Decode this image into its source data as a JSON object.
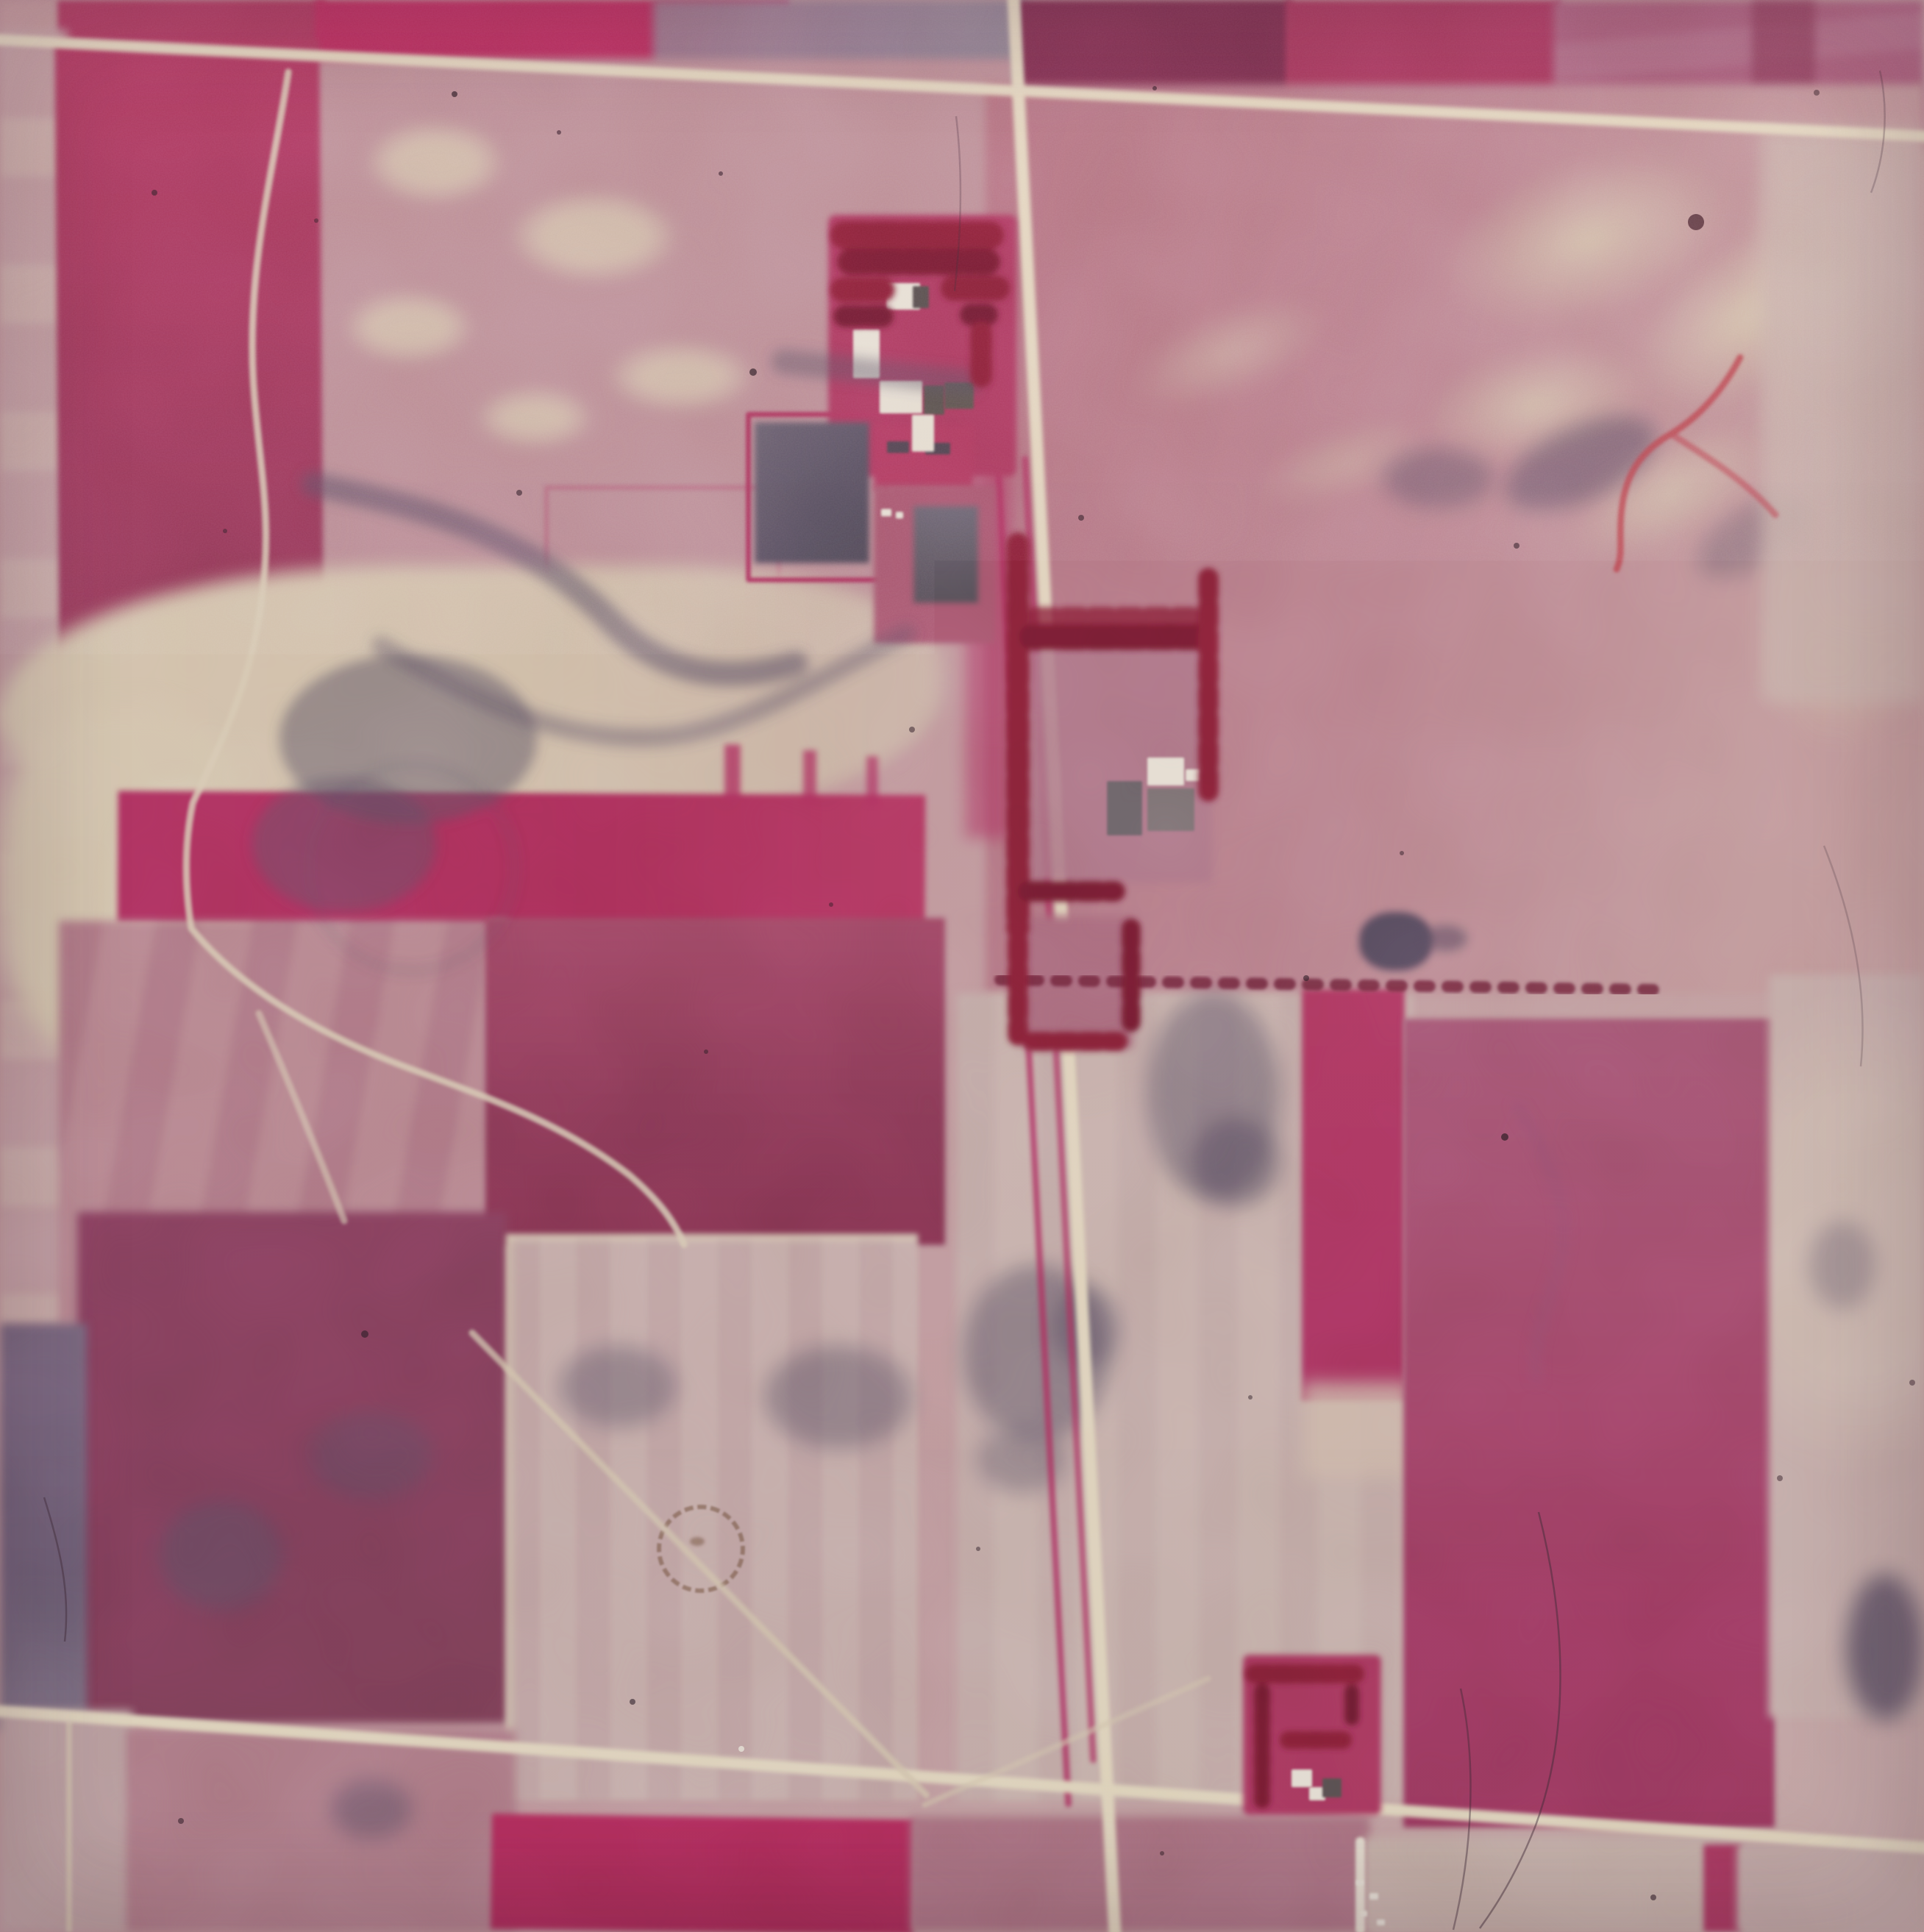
{
  "scene": {
    "title": "Color-infrared aerial photograph of farmland",
    "description": "False-color infrared aerial survey film frame over a rural section-line grid. Healthy vegetation registers crimson and magenta; fallow and harvested fields are pale mauve and cream. A north-south gravel road crosses two east-west roads; three farmsteads with dark-red shelterbelt windbreaks sit along the roads. A meandering creek, dark drainage shadows, a circular crop mark, fence-line shrub rows, and film artifacts (dust specks, hairline scratches, grain) are visible.",
    "media": "film transparency, scanned",
    "labels": {
      "photo": "color-infrared aerial photograph of agricultural fields",
      "top_road": "east-west gravel road (north)",
      "bottom_road": "east-west gravel road (south)",
      "vertical_road": "north-south gravel road",
      "farm_lane": "farm lane heading south",
      "diag_track": "diagonal field track",
      "farmstead_north": "farmstead with windbreak trees (north, west of road)",
      "farmstead_center": "farmstead with L-shaped shelterbelt (center, east of road)",
      "farmstead_south": "farmstead with windbreak trees (south)",
      "creek": "meandering creek and branch channels",
      "red_creek": "red drainage channel",
      "crimson_band": "bright crimson cropped band",
      "valley": "pale eroded valley floor",
      "drainage": "dark wet drainage pattern",
      "ring": "circular crop mark",
      "shrub_line": "fence-line shrub row",
      "pond": "dark pond shadow",
      "grain": "film grain",
      "scratch": "film scratch",
      "dust": "dust speck"
    }
  },
  "palette": {
    "cream": "#e7dcc2",
    "cream2": "#d9ccb2",
    "mauve": "#bd9097",
    "mauve2": "#b27f8a",
    "rose": "#b3717f",
    "rosepale": "#c49a9c",
    "palefield": "#c6abaa",
    "paleg": "#c9b3ae",
    "crimson": "#b23260",
    "crimson2": "#bb2f5e",
    "magenta": "#a43e63",
    "maroon": "#8c3f5b",
    "maroon2": "#7d3150",
    "dusky": "#87405a",
    "plum": "#9b7489",
    "slate": "#8d8894",
    "slatedark": "#5a5164",
    "purple": "#74657c",
    "treered": "#8a2038",
    "treedark": "#701a30",
    "white": "#ece7da",
    "bgray": "#5f5954",
    "redcreek": "#c0454e",
    "ring": "#6f4d36",
    "dust": "#281c24",
    "scratch": "#3c2b35",
    "seam": "#d4bfae"
  }
}
